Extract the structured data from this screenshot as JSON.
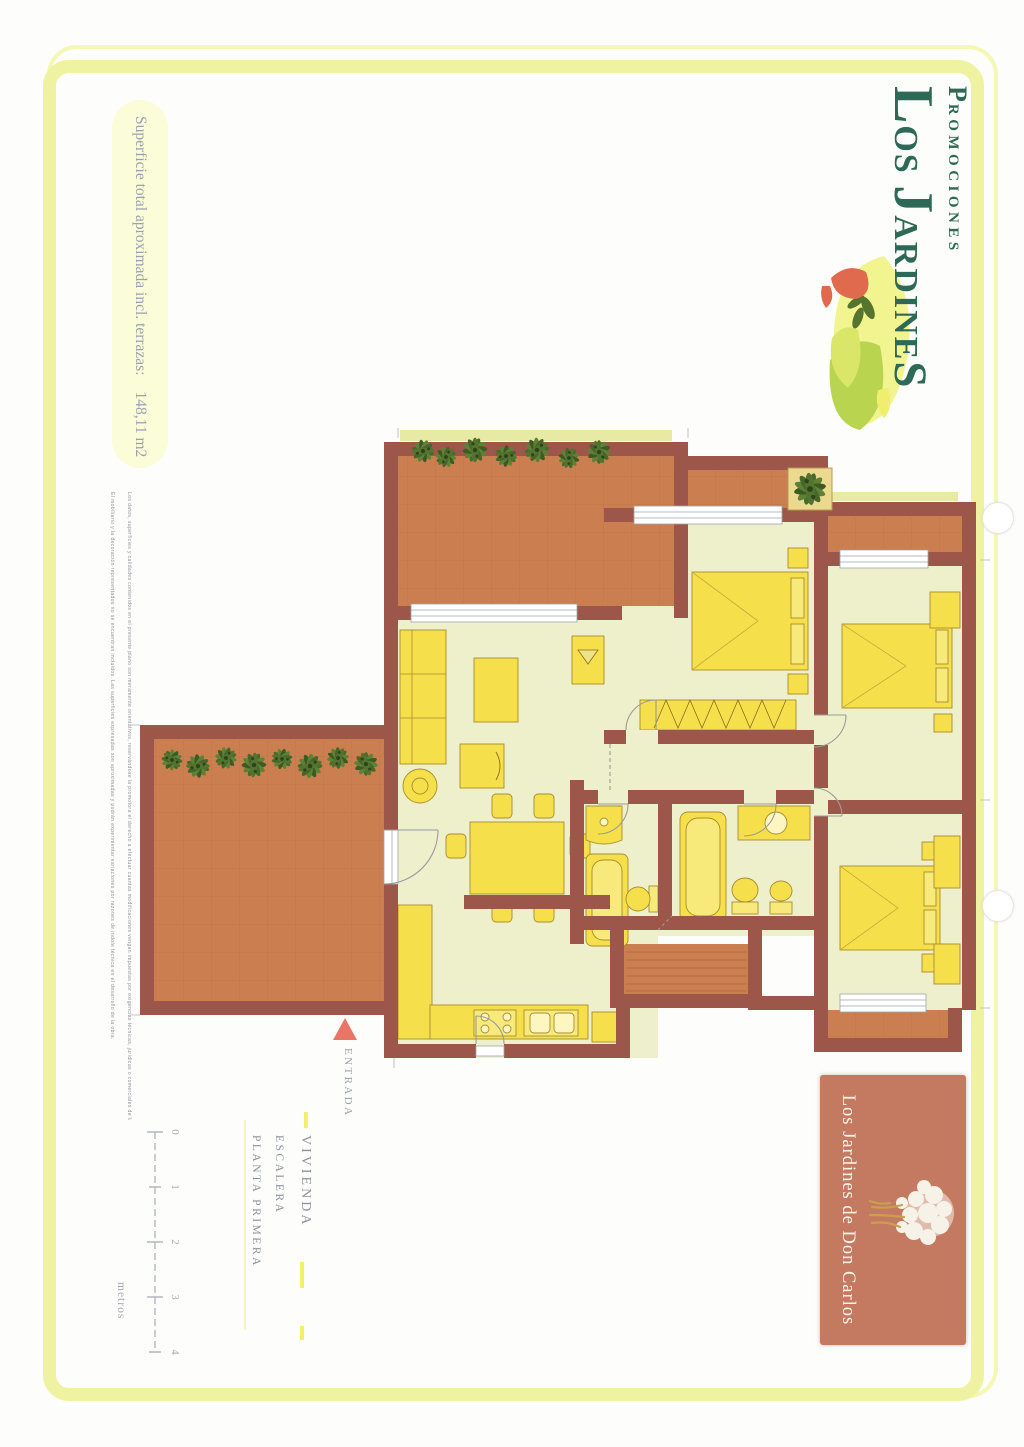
{
  "logo": {
    "promociones_initial": "P",
    "promociones_rest": "ROMOCIONES",
    "los_initial": "L",
    "los_rest": "OS ",
    "jardines_initial": "J",
    "jardines_mid": "ARDINE",
    "jardines_end": "S"
  },
  "surface_note": {
    "label": "Superficie total aproximada incl. terrazas:",
    "value": "148,11 m2"
  },
  "fine_print": {
    "line1": "Los datos, superficies y calidades contenidos en el presente plano son meramente orientativos, reservándose la promotora el derecho a efectuar cuantas modificaciones vengan impuestas por exigencias técnicas, jurídicas o comerciales de la dirección facultativa u organismos oficiales competentes.",
    "line2": "El mobiliario y la decoración representados no se encuentran incluidos. Las superficies expresadas son aproximadas y podrán experimentar variaciones por razones de índole técnica en el desarrollo de la obra."
  },
  "legend": {
    "vivienda": "VIVIENDA",
    "escalera": "ESCALERA",
    "planta_primera": "PLANTA PRIMERA"
  },
  "entrance_label": "ENTRADA",
  "scale_bar": {
    "ticks": [
      "0",
      "1",
      "2",
      "3",
      "4"
    ],
    "unit": "metros"
  },
  "project_box": {
    "name": "Los Jardines de Don Carlos"
  },
  "colors": {
    "frame_yellow": "#eff3a1",
    "wall_maroon": "#9d574a",
    "terrace_terracotta": "#cb7e4f",
    "room_pale": "#eef0cc",
    "furniture_yellow": "#f5e04b",
    "logo_green": "#2d6956",
    "project_box_salmon": "#c47a61",
    "entrance_arrow": "#e87566",
    "plant_green": "#4a6a2b",
    "text_gray": "#98a1aa"
  }
}
